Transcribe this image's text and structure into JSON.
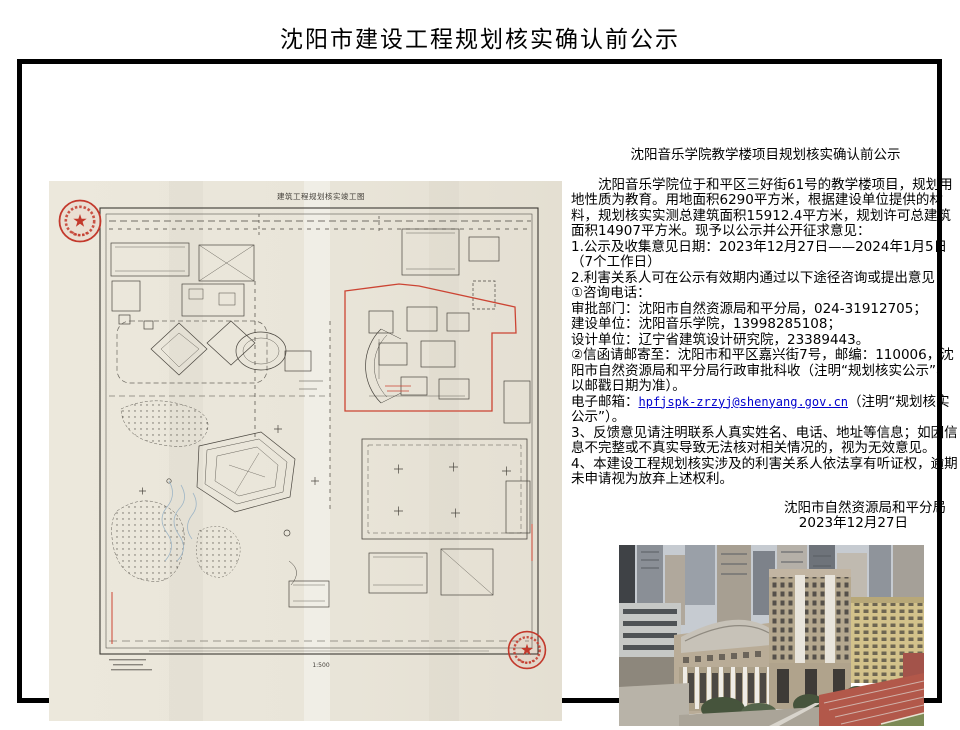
{
  "page": {
    "title": "沈阳市建设工程规划核实确认前公示"
  },
  "colors": {
    "seal_red": "#c3392c",
    "boundary_red": "#cc4433",
    "link_blue": "#0000cc",
    "paper_beige": "#e9e5d9",
    "track_red": "#b2584a"
  },
  "drawing": {
    "title": "建筑工程规划核实竣工图",
    "scale": "1:500"
  },
  "notice": {
    "subtitle": "沈阳音乐学院教学楼项目规划核实确认前公示",
    "body_para": "沈阳音乐学院位于和平区三好街61号的教学楼项目，规划用地性质为教育。用地面积6290平方米，根据建设单位提供的材料，规划核实实测总建筑面积15912.4平方米，规划许可总建筑面积14907平方米。现予以公示并公开征求意见：",
    "line_date": "1.公示及收集意见日期：2023年12月27日——2024年1月5日（7个工作日）",
    "line_channels": "2.利害关系人可在公示有效期内通过以下途径咨询或提出意见：",
    "phone_header": "①咨询电话：",
    "phone_approval": "审批部门：沈阳市自然资源局和平分局，024-31912705；",
    "phone_builder": "建设单位：沈阳音乐学院，13998285108；",
    "phone_designer": "设计单位：辽宁省建筑设计研究院，23389443。",
    "mail_line": "②信函请邮寄至：沈阳市和平区嘉兴街7号，邮编：110006，沈阳市自然资源局和平分局行政审批科收（注明“规划核实公示”、以邮戳日期为准）。",
    "email_label": "电子邮箱：",
    "email": "hpfjspk-zrzyj@shenyang.gov.cn",
    "email_suffix": "（注明“规划核实公示”）。",
    "item3": "3、反馈意见请注明联系人真实姓名、电话、地址等信息；如因信息不完整或不真实导致无法核对相关情况的，视为无效意见。",
    "item4": "4、本建设工程规划核实涉及的利害关系人依法享有听证权，逾期未申请视为放弃上述权利。"
  },
  "signature": {
    "agency": "沈阳市自然资源局和平分局",
    "date": "2023年12月27日"
  }
}
